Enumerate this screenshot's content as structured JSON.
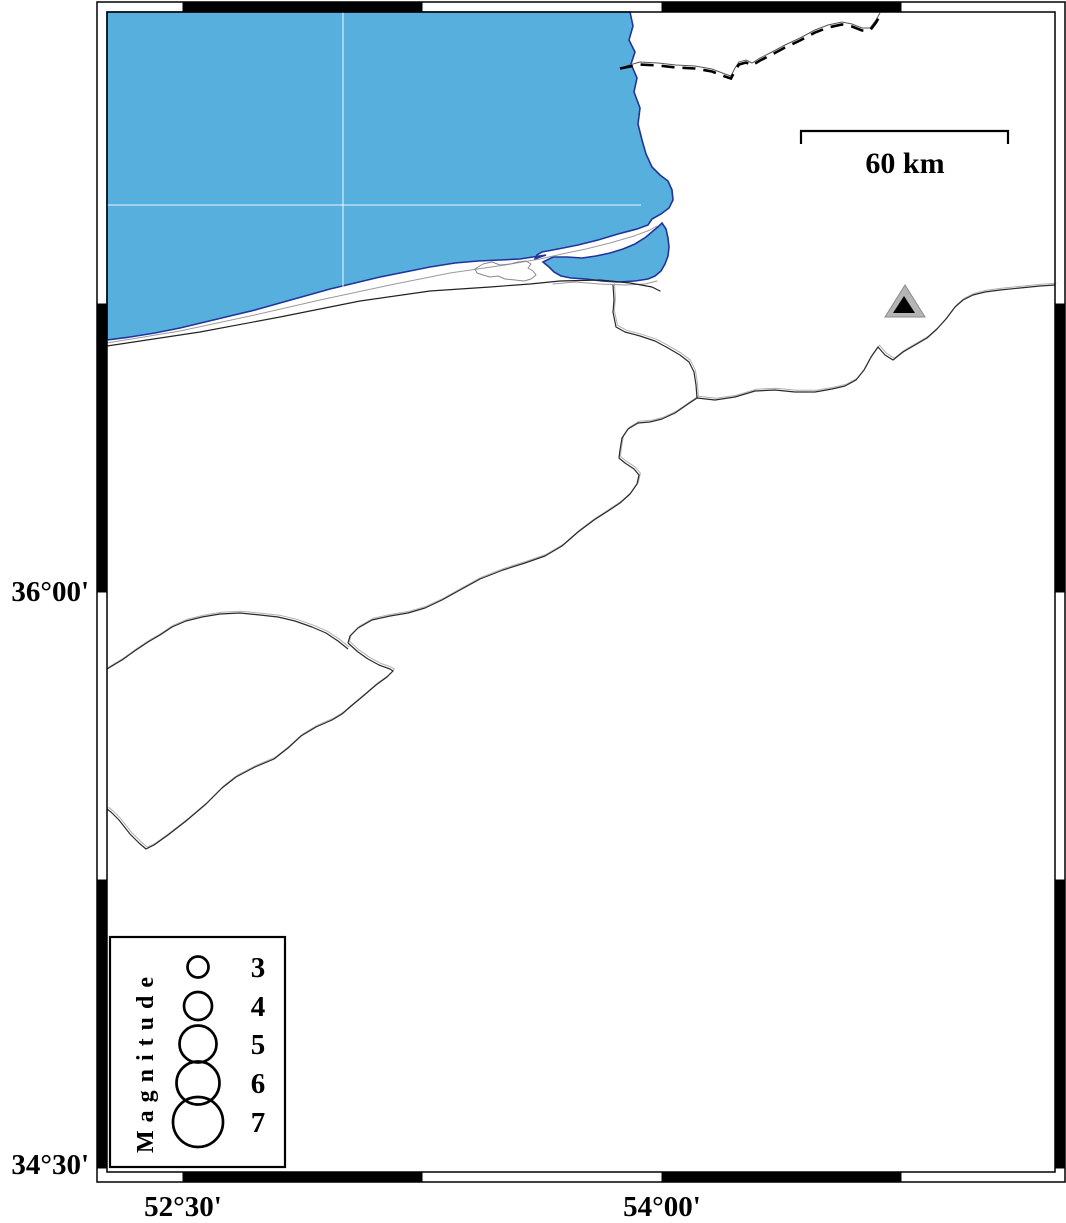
{
  "figure": {
    "type": "station-seismicity-map",
    "frame": {
      "bottom_labels": [
        "52°30'",
        "54°00'"
      ],
      "left_labels": [
        "36°00'",
        "34°30'"
      ]
    },
    "scale_bar": {
      "label": "60 km"
    },
    "legend": {
      "title": "Magnitude",
      "entries": [
        {
          "magnitude": "3",
          "radius": 10.5
        },
        {
          "magnitude": "4",
          "radius": 14
        },
        {
          "magnitude": "5",
          "radius": 18.5
        },
        {
          "magnitude": "6",
          "radius": 21.5
        },
        {
          "magnitude": "7",
          "radius": 25
        }
      ]
    },
    "markers": {
      "station": {
        "shape": "triangle",
        "fill_outer": "#b5b5b5",
        "fill_inner": "#000000"
      }
    },
    "colors": {
      "sea": "#57AFDE",
      "shoreline": "#22339A",
      "land": "#FFFFFF",
      "frame": "#000000",
      "boundary_line": "#2a2a2a",
      "boundary_shadow": "#b0b0b0"
    }
  }
}
